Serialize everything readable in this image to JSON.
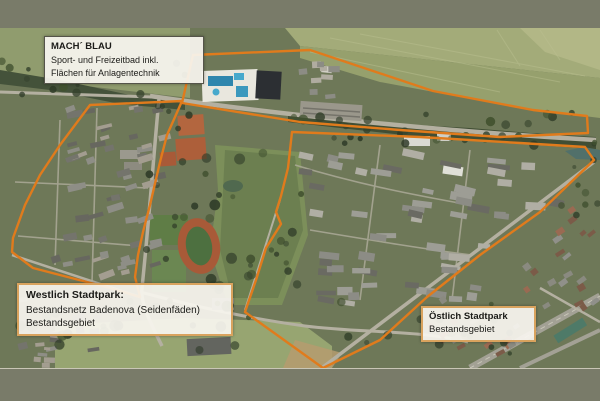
{
  "frame": {
    "bar_color": "#797b69",
    "map_area": {
      "top": 28,
      "bottom": 368,
      "width": 600
    }
  },
  "map": {
    "type": "satellite-aerial-photo",
    "annotation_color": "#e07b1c",
    "regions": [
      {
        "id": "machblau",
        "label_title": "MACH´ BLAU",
        "label_lines": [
          "Sport- und Freizeitbad inkl.",
          "Flächen für Anlagentechnik"
        ],
        "points": "193,55 310,50 433,91 533,110 587,116 588,133 500,137 400,130 300,122 182,103"
      },
      {
        "id": "westlich-stadtpark",
        "label_title": "Westlich Stadtpark:",
        "label_lines": [
          "Bestandsnetz Badenova (Seidenfäden)",
          "Bestandsgebiet"
        ],
        "points": "90,105 182,101 175,117 167,135 160,162 150,205 143,232 138,255 135,277 140,297 110,288 33,268 12,252 13,238 25,205 40,175 60,145"
      },
      {
        "id": "oestlich-stadtpark",
        "label_title": "Östlich Stadtpark",
        "label_lines": [
          "Bestandsgebiet"
        ],
        "points": "292,132 420,137 520,143 585,147 594,160 540,212 480,255 427,297 380,340 323,368 245,312 256,280 266,248 281,224 276,212 281,196 288,168"
      }
    ]
  }
}
